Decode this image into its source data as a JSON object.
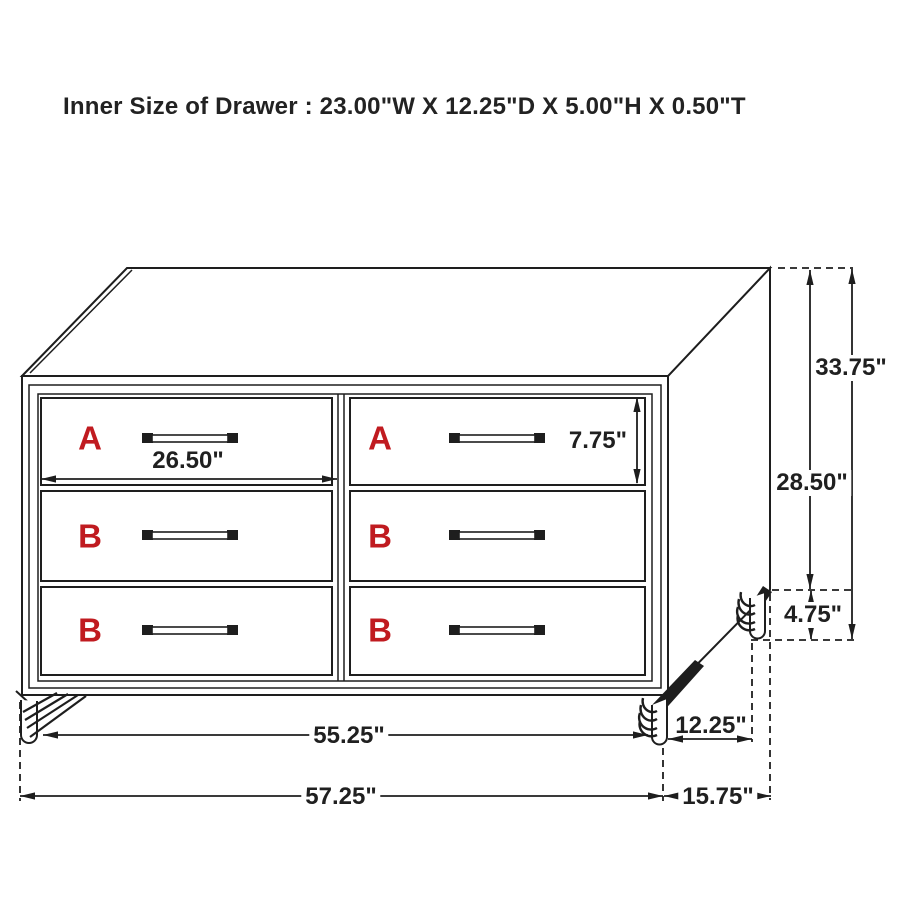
{
  "title": "Inner Size of Drawer : 23.00\"W X 12.25\"D X 5.00\"H X 0.50\"T",
  "drawers": [
    {
      "label": "A"
    },
    {
      "label": "A"
    },
    {
      "label": "B"
    },
    {
      "label": "B"
    },
    {
      "label": "B"
    },
    {
      "label": "B"
    }
  ],
  "dimensions": {
    "drawer_face_width": "26.50\"",
    "drawer_face_height": "7.75\"",
    "overall_height": "33.75\"",
    "case_height": "28.50\"",
    "leg_height": "4.75\"",
    "front_leg_span": "55.25\"",
    "overall_width": "57.25\"",
    "side_leg_span": "12.25\"",
    "overall_depth": "15.75\""
  },
  "colors": {
    "line": "#1e1e1e",
    "accent_red": "#c01b20",
    "background": "#ffffff"
  }
}
